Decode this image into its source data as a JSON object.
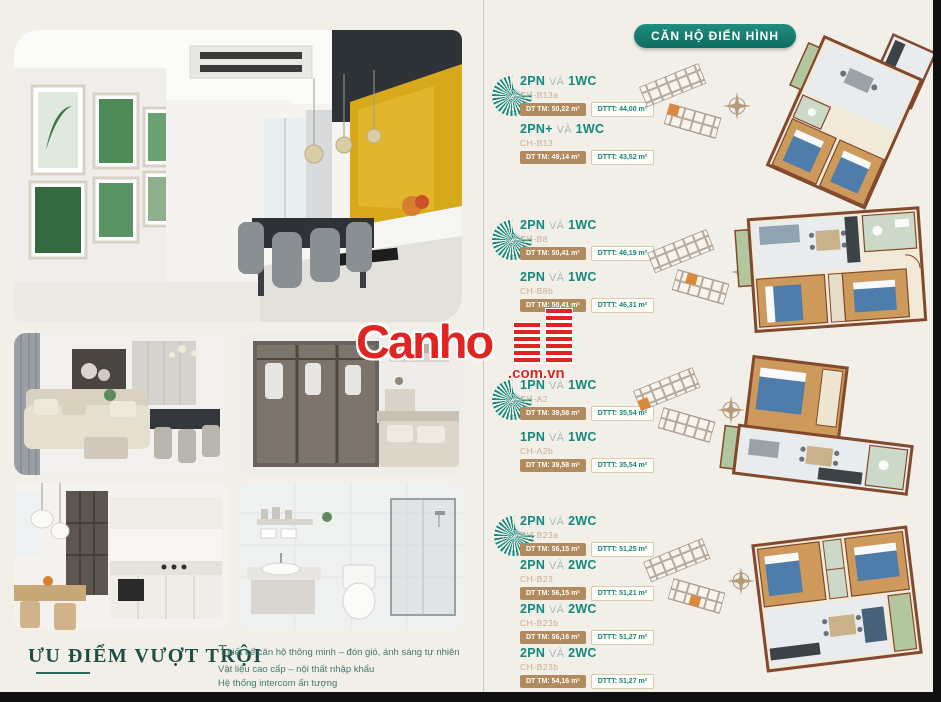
{
  "colors": {
    "teal": "#13897d",
    "teal_dark": "#156e62",
    "tan": "#b18a5e",
    "tan_light": "#c9ae8e",
    "cream": "#f2efe8",
    "red": "#e02520",
    "wall": "#82492c",
    "wood": "#cd9a5c",
    "bed": "#4e7dab",
    "bal": "#b3c79e",
    "yellow": "#d9a91c",
    "serifgreen": "#1d4f46"
  },
  "header": {
    "badge": "CĂN HỘ ĐIỂN HÌNH"
  },
  "watermark": {
    "brand": "Canho",
    "suffix": ".com.vn"
  },
  "icons": {
    "fan": "fan-spiral-icon",
    "compass": "compass-rose-icon",
    "building": "building-bars-icon"
  },
  "features": {
    "title": "ƯU ĐIỂM VƯỢT TRỘI",
    "lines": [
      "Thiết kế căn hộ thông minh – đón gió, ánh sáng tự nhiên",
      "Vật liệu cao cấp – nội thất nhập khẩu",
      "Hệ thống intercom ấn tượng",
      "Pháp lý minh bạch – Sinh lời nhanh chóng"
    ]
  },
  "groups": [
    {
      "items": [
        {
          "bed": "2PN",
          "conj": "VÀ",
          "wc": "1WC",
          "code": "CH-B13a",
          "dt_tm": "DT TM: 50,22 m²",
          "dt_tt": "DTTT: 44,00 m²"
        },
        {
          "bed": "2PN+",
          "conj": "VÀ",
          "wc": "1WC",
          "code": "CH-B13",
          "dt_tm": "DT TM: 49,14 m²",
          "dt_tt": "DTTT: 43,52 m²"
        }
      ]
    },
    {
      "items": [
        {
          "bed": "2PN",
          "conj": "VÀ",
          "wc": "1WC",
          "code": "CH-B8",
          "dt_tm": "DT TM: 50,41 m²",
          "dt_tt": "DTTT: 46,19 m²"
        },
        {
          "bed": "2PN",
          "conj": "VÀ",
          "wc": "1WC",
          "code": "CH-B8b",
          "dt_tm": "DT TM: 50,41 m²",
          "dt_tt": "DTTT: 46,31 m²"
        }
      ]
    },
    {
      "items": [
        {
          "bed": "1PN",
          "conj": "VÀ",
          "wc": "1WC",
          "code": "CH-A2",
          "dt_tm": "DT TM: 39,58 m²",
          "dt_tt": "DTTT: 35,54 m²"
        },
        {
          "bed": "1PN",
          "conj": "VÀ",
          "wc": "1WC",
          "code": "CH-A2b",
          "dt_tm": "DT TM: 39,58 m²",
          "dt_tt": "DTTT: 35,54 m²"
        }
      ]
    },
    {
      "items": [
        {
          "bed": "2PN",
          "conj": "VÀ",
          "wc": "2WC",
          "code": "CH-B23a",
          "dt_tm": "DT TM: 56,15 m²",
          "dt_tt": "DTTT: 51,25 m²"
        },
        {
          "bed": "2PN",
          "conj": "VÀ",
          "wc": "2WC",
          "code": "CH-B23",
          "dt_tm": "DT TM: 56,15 m²",
          "dt_tt": "DTTT: 51,21 m²"
        },
        {
          "bed": "2PN",
          "conj": "VÀ",
          "wc": "2WC",
          "code": "CH-B23b",
          "dt_tm": "DT TM: 56,16 m²",
          "dt_tt": "DTTT: 51,27 m²"
        },
        {
          "bed": "2PN",
          "conj": "VÀ",
          "wc": "2WC",
          "code": "CH-B23b",
          "dt_tm": "DT TM: 54,16 m²",
          "dt_tt": "DTTT: 51,27 m²"
        }
      ]
    }
  ]
}
